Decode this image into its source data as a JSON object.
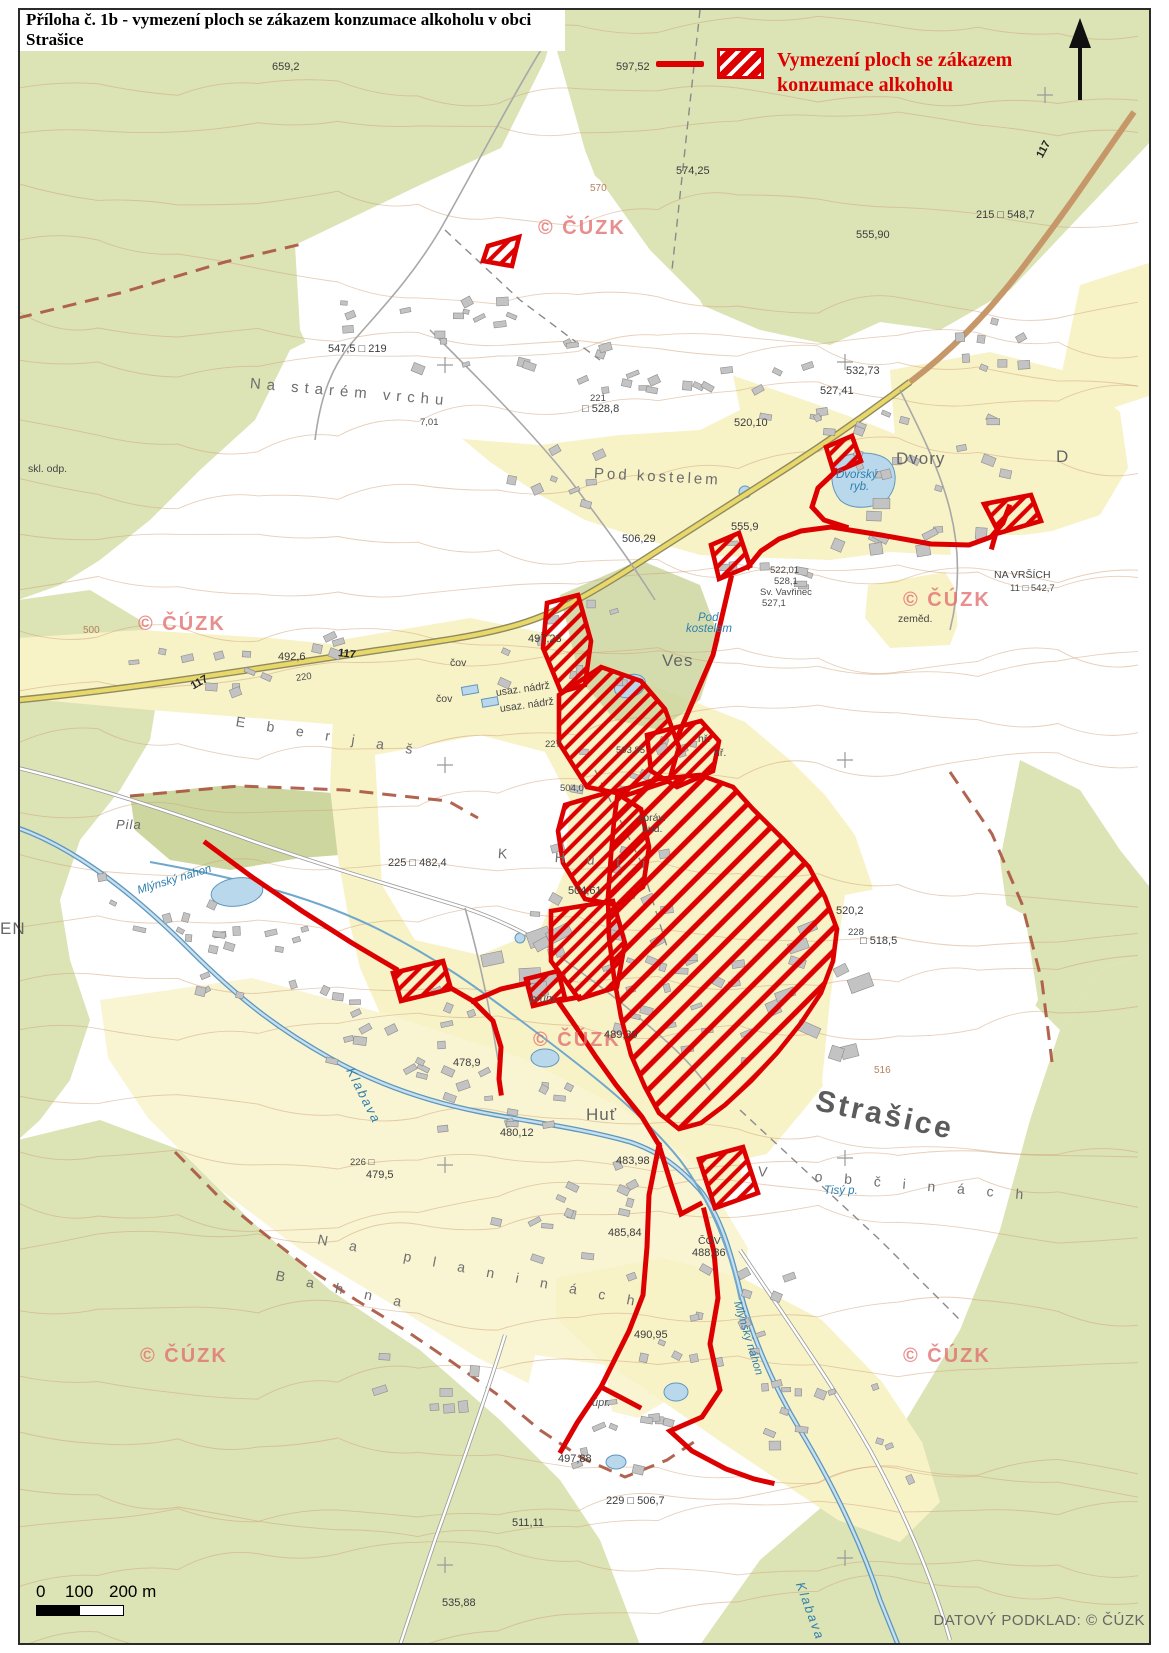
{
  "page": {
    "title": "Příloha č. 1b - vymezení ploch se zákazem konzumace alkoholu v obci Strašice"
  },
  "legend": {
    "line1": "Vymezení ploch se zákazem",
    "line2": "konzumace alkoholu"
  },
  "scale_bar": {
    "tick0": "0",
    "tick100": "100",
    "tick200": "200 m"
  },
  "attribution": "DATOVÝ PODKLAD: ©  ČÚZK",
  "colors": {
    "prohibition_red": "#dd0000",
    "forest_green": "#dce3b5",
    "builtup_cream": "#f8f2c7",
    "water_blue": "#b9d8ec",
    "contour_brown": "#cf9f76",
    "watermark_pink": "#e26e6e"
  },
  "map": {
    "labels": [
      {
        "t": "659,2",
        "x": 272,
        "y": 62,
        "c": "t-elev"
      },
      {
        "t": "597,52",
        "x": 616,
        "y": 62,
        "c": "t-elev"
      },
      {
        "t": "574,25",
        "x": 676,
        "y": 166,
        "c": "t-elev"
      },
      {
        "t": "555,90",
        "x": 856,
        "y": 230,
        "c": "t-elev"
      },
      {
        "t": "215 □ 548,7",
        "x": 976,
        "y": 210,
        "c": "t-elev"
      },
      {
        "t": "117",
        "x": 1040,
        "y": 152,
        "c": "t-road",
        "r": -62
      },
      {
        "t": "© ČÚZK",
        "x": 538,
        "y": 218,
        "c": "watermark"
      },
      {
        "t": "570",
        "x": 590,
        "y": 184,
        "c": "t-contour"
      },
      {
        "t": "547,5 □ 219",
        "x": 328,
        "y": 344,
        "c": "t-elev"
      },
      {
        "t": "Na starém vrchu",
        "x": 250,
        "y": 376,
        "c": "t-spread2",
        "r": 5
      },
      {
        "t": "7,01",
        "x": 420,
        "y": 418,
        "c": "t-elev-sm"
      },
      {
        "t": "221",
        "x": 590,
        "y": 394,
        "c": "t-elev-sm"
      },
      {
        "t": "□ 528,8",
        "x": 582,
        "y": 404,
        "c": "t-elev"
      },
      {
        "t": "532,73",
        "x": 846,
        "y": 366,
        "c": "t-elev"
      },
      {
        "t": "527,41",
        "x": 820,
        "y": 386,
        "c": "t-elev"
      },
      {
        "t": "520,10",
        "x": 734,
        "y": 418,
        "c": "t-elev"
      },
      {
        "t": "Pod kostelem",
        "x": 594,
        "y": 466,
        "c": "t-place",
        "r": 3
      },
      {
        "t": "Dvory",
        "x": 896,
        "y": 450,
        "c": "t-place-md"
      },
      {
        "t": "Dvorský",
        "x": 836,
        "y": 470,
        "c": "t-blue"
      },
      {
        "t": "ryb.",
        "x": 850,
        "y": 482,
        "c": "t-blue"
      },
      {
        "t": "D",
        "x": 1056,
        "y": 448,
        "c": "t-place-md"
      },
      {
        "t": "skl. odp.",
        "x": 28,
        "y": 464,
        "c": "t-small"
      },
      {
        "t": "NA VRŠÍCH",
        "x": 994,
        "y": 570,
        "c": "t-small"
      },
      {
        "t": "11 □ 542,7",
        "x": 1010,
        "y": 584,
        "c": "t-elev-sm"
      },
      {
        "t": "506,29",
        "x": 622,
        "y": 534,
        "c": "t-elev"
      },
      {
        "t": "555,9",
        "x": 731,
        "y": 522,
        "c": "t-elev"
      },
      {
        "t": "522,01",
        "x": 770,
        "y": 566,
        "c": "t-elev-sm"
      },
      {
        "t": "528,1",
        "x": 774,
        "y": 577,
        "c": "t-elev-sm"
      },
      {
        "t": "Sv. Vavřinec",
        "x": 760,
        "y": 588,
        "c": "t-elev-sm"
      },
      {
        "t": "527,1",
        "x": 762,
        "y": 599,
        "c": "t-elev-sm"
      },
      {
        "t": "zeměd.",
        "x": 898,
        "y": 614,
        "c": "t-small"
      },
      {
        "t": "© ČÚZK",
        "x": 138,
        "y": 614,
        "c": "watermark"
      },
      {
        "t": "© ČÚZK",
        "x": 903,
        "y": 590,
        "c": "watermark"
      },
      {
        "t": "497,23",
        "x": 528,
        "y": 634,
        "c": "t-elev"
      },
      {
        "t": "Ves",
        "x": 662,
        "y": 652,
        "c": "t-place-md"
      },
      {
        "t": "čov",
        "x": 450,
        "y": 658,
        "c": "t-small"
      },
      {
        "t": "čov",
        "x": 436,
        "y": 694,
        "c": "t-small"
      },
      {
        "t": "usaz. nádrž",
        "x": 496,
        "y": 688,
        "c": "t-small",
        "r": -8
      },
      {
        "t": "usaz. nádrž",
        "x": 500,
        "y": 704,
        "c": "t-small",
        "r": -8
      },
      {
        "t": "Pod",
        "x": 698,
        "y": 613,
        "c": "t-blue"
      },
      {
        "t": "kostelem",
        "x": 686,
        "y": 624,
        "c": "t-blue"
      },
      {
        "t": "hř.",
        "x": 698,
        "y": 734,
        "c": "t-small"
      },
      {
        "t": "hř.",
        "x": 714,
        "y": 748,
        "c": "t-small"
      },
      {
        "t": "E b e r j a š",
        "x": 236,
        "y": 714,
        "c": "t-spread",
        "r": 9
      },
      {
        "t": "117",
        "x": 338,
        "y": 648,
        "c": "t-road",
        "r": 7
      },
      {
        "t": "117",
        "x": 192,
        "y": 682,
        "c": "t-road",
        "r": -30
      },
      {
        "t": "492,6",
        "x": 278,
        "y": 652,
        "c": "t-elev"
      },
      {
        "t": "220",
        "x": 296,
        "y": 674,
        "c": "t-elev-sm",
        "r": -8
      },
      {
        "t": "500",
        "x": 83,
        "y": 626,
        "c": "t-contour"
      },
      {
        "t": "Pila",
        "x": 116,
        "y": 818,
        "c": "t-place-it"
      },
      {
        "t": "Mlýnský náhon",
        "x": 138,
        "y": 886,
        "c": "t-blue",
        "r": -17
      },
      {
        "t": "225 □ 482,4",
        "x": 388,
        "y": 858,
        "c": "t-elev"
      },
      {
        "t": "K   H u t i",
        "x": 498,
        "y": 846,
        "c": "t-spread",
        "r": 4
      },
      {
        "t": "227",
        "x": 545,
        "y": 740,
        "c": "t-elev-sm"
      },
      {
        "t": "503,85",
        "x": 616,
        "y": 746,
        "c": "t-elev-sm"
      },
      {
        "t": "504,0",
        "x": 560,
        "y": 784,
        "c": "t-elev-sm"
      },
      {
        "t": "504,61",
        "x": 568,
        "y": 886,
        "c": "t-elev"
      },
      {
        "t": "správ.",
        "x": 638,
        "y": 813,
        "c": "t-small"
      },
      {
        "t": "bud.",
        "x": 642,
        "y": 824,
        "c": "t-small"
      },
      {
        "t": "© ČÚZK",
        "x": 533,
        "y": 1030,
        "c": "watermark"
      },
      {
        "t": "prům.",
        "x": 530,
        "y": 994,
        "c": "t-small-it"
      },
      {
        "t": "489,39",
        "x": 604,
        "y": 1030,
        "c": "t-elev"
      },
      {
        "t": "478,9",
        "x": 453,
        "y": 1058,
        "c": "t-elev"
      },
      {
        "t": "Klabava",
        "x": 350,
        "y": 1062,
        "c": "t-blue-md",
        "r": 63
      },
      {
        "t": "Huť",
        "x": 586,
        "y": 1106,
        "c": "t-place-md"
      },
      {
        "t": "480,12",
        "x": 500,
        "y": 1128,
        "c": "t-elev"
      },
      {
        "t": "483,98",
        "x": 616,
        "y": 1156,
        "c": "t-elev"
      },
      {
        "t": "226 □",
        "x": 350,
        "y": 1158,
        "c": "t-elev-sm"
      },
      {
        "t": "479,5",
        "x": 366,
        "y": 1170,
        "c": "t-elev"
      },
      {
        "t": "520,2",
        "x": 836,
        "y": 906,
        "c": "t-elev"
      },
      {
        "t": "228",
        "x": 848,
        "y": 928,
        "c": "t-elev-sm"
      },
      {
        "t": "□ 518,5",
        "x": 860,
        "y": 936,
        "c": "t-elev"
      },
      {
        "t": "516",
        "x": 874,
        "y": 1066,
        "c": "t-contour"
      },
      {
        "t": "Strašice",
        "x": 816,
        "y": 1086,
        "c": "t-place-lg",
        "r": 12
      },
      {
        "t": "V   o b č i n á c h",
        "x": 758,
        "y": 1164,
        "c": "t-spread",
        "r": 5
      },
      {
        "t": "Tisý p.",
        "x": 824,
        "y": 1186,
        "c": "t-blue"
      },
      {
        "t": "485,84",
        "x": 608,
        "y": 1228,
        "c": "t-elev"
      },
      {
        "t": "ČOV",
        "x": 698,
        "y": 1236,
        "c": "t-small"
      },
      {
        "t": "488,86",
        "x": 692,
        "y": 1248,
        "c": "t-elev"
      },
      {
        "t": "N a   p l a n i n á c h",
        "x": 318,
        "y": 1232,
        "c": "t-spread",
        "r": 11
      },
      {
        "t": "B a h n a",
        "x": 276,
        "y": 1268,
        "c": "t-spread",
        "r": 12
      },
      {
        "t": "490,95",
        "x": 634,
        "y": 1330,
        "c": "t-elev"
      },
      {
        "t": "Mlýnský náhon",
        "x": 736,
        "y": 1296,
        "c": "t-blue",
        "r": 73
      },
      {
        "t": "úpr.",
        "x": 592,
        "y": 1398,
        "c": "t-small-it"
      },
      {
        "t": "497,88",
        "x": 558,
        "y": 1454,
        "c": "t-elev"
      },
      {
        "t": "229 □ 506,7",
        "x": 606,
        "y": 1496,
        "c": "t-elev"
      },
      {
        "t": "511,11",
        "x": 512,
        "y": 1518,
        "c": "t-elev"
      },
      {
        "t": "535,88",
        "x": 442,
        "y": 1598,
        "c": "t-elev"
      },
      {
        "t": "Klabava",
        "x": 800,
        "y": 1576,
        "c": "t-blue-md",
        "r": 70
      },
      {
        "t": "© ČÚZK",
        "x": 140,
        "y": 1346,
        "c": "watermark"
      },
      {
        "t": "© ČÚZK",
        "x": 903,
        "y": 1346,
        "c": "watermark"
      },
      {
        "t": "EN",
        "x": 0,
        "y": 920,
        "c": "t-place-md"
      }
    ]
  }
}
